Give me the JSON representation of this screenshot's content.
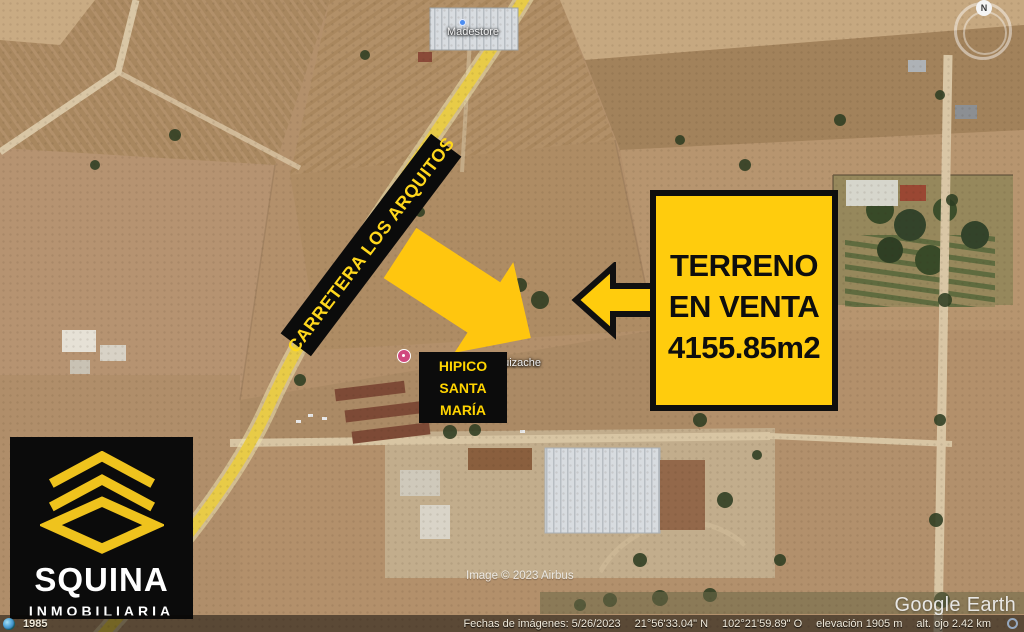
{
  "banner": {
    "road_name": "CARRETERA LOS ARQUITOS"
  },
  "sale_sign": {
    "line1": "TERRENO",
    "line2": "EN VENTA",
    "line3": "4155.85m2"
  },
  "hipico_label": {
    "line1": "HIPICO",
    "line2": "SANTA",
    "line3": "MARÍA"
  },
  "logo": {
    "name": "SQUINA",
    "subtitle": "INMOBILIARIA"
  },
  "map": {
    "poi_store_label": "Madestore",
    "street_label": "huizache"
  },
  "compass": {
    "north": "N"
  },
  "watermarks": {
    "brand": "Google Earth",
    "imagery_credit": "Image © 2023 Airbus"
  },
  "status_bar": {
    "history_year": "1985",
    "imagery_date": "Fechas de imágenes: 5/26/2023",
    "latitude": "21°56'33.04\" N",
    "longitude": "102°21'59.89\" O",
    "elevation": "elevación 1905 m",
    "eye_altitude": "alt. ojo 2.42 km"
  },
  "colors": {
    "accent_yellow": "#FFCC0D",
    "panel_black": "#0C0C0C",
    "label_yellow": "#FFD71C"
  }
}
